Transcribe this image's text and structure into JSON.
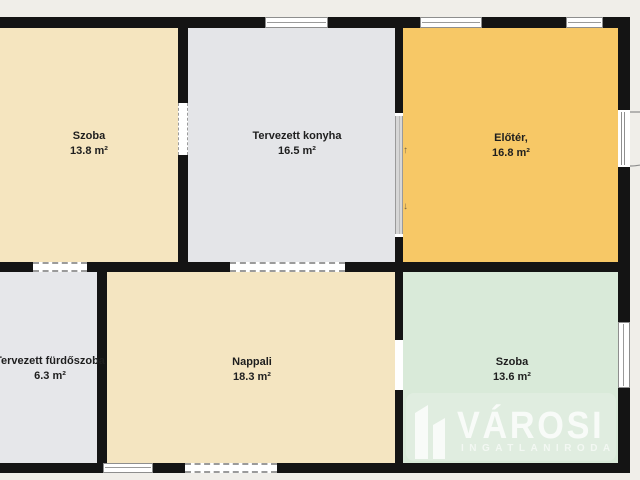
{
  "canvas": {
    "background": "#f0eee9",
    "wall_color": "#141414",
    "symbol_outline": "#8e8e8e"
  },
  "rooms": [
    {
      "name": "Szoba",
      "area": "13.8 m²",
      "color": "#f5e5bf"
    },
    {
      "name": "Tervezett konyha",
      "area": "16.5 m²",
      "color": "#e4e5e8"
    },
    {
      "name": "Előtér,",
      "area": "16.8 m²",
      "color": "#f7c866"
    },
    {
      "name": "Tervezett fürdőszoba",
      "area": "6.3 m²",
      "color": "#e6e7ea"
    },
    {
      "name": "Nappali",
      "area": "18.3 m²",
      "color": "#f4e5c1"
    },
    {
      "name": "Szoba",
      "area": "13.6 m²",
      "color": "#d9ead9"
    }
  ],
  "watermark": {
    "brand": "VÁROSI",
    "subtitle": "INGATLANIRODA",
    "color": "rgba(255,255,255,0.78)",
    "subtitle_color": "rgba(255,255,255,0.6)",
    "backdrop_color": "rgba(255,255,255,0.18)"
  }
}
